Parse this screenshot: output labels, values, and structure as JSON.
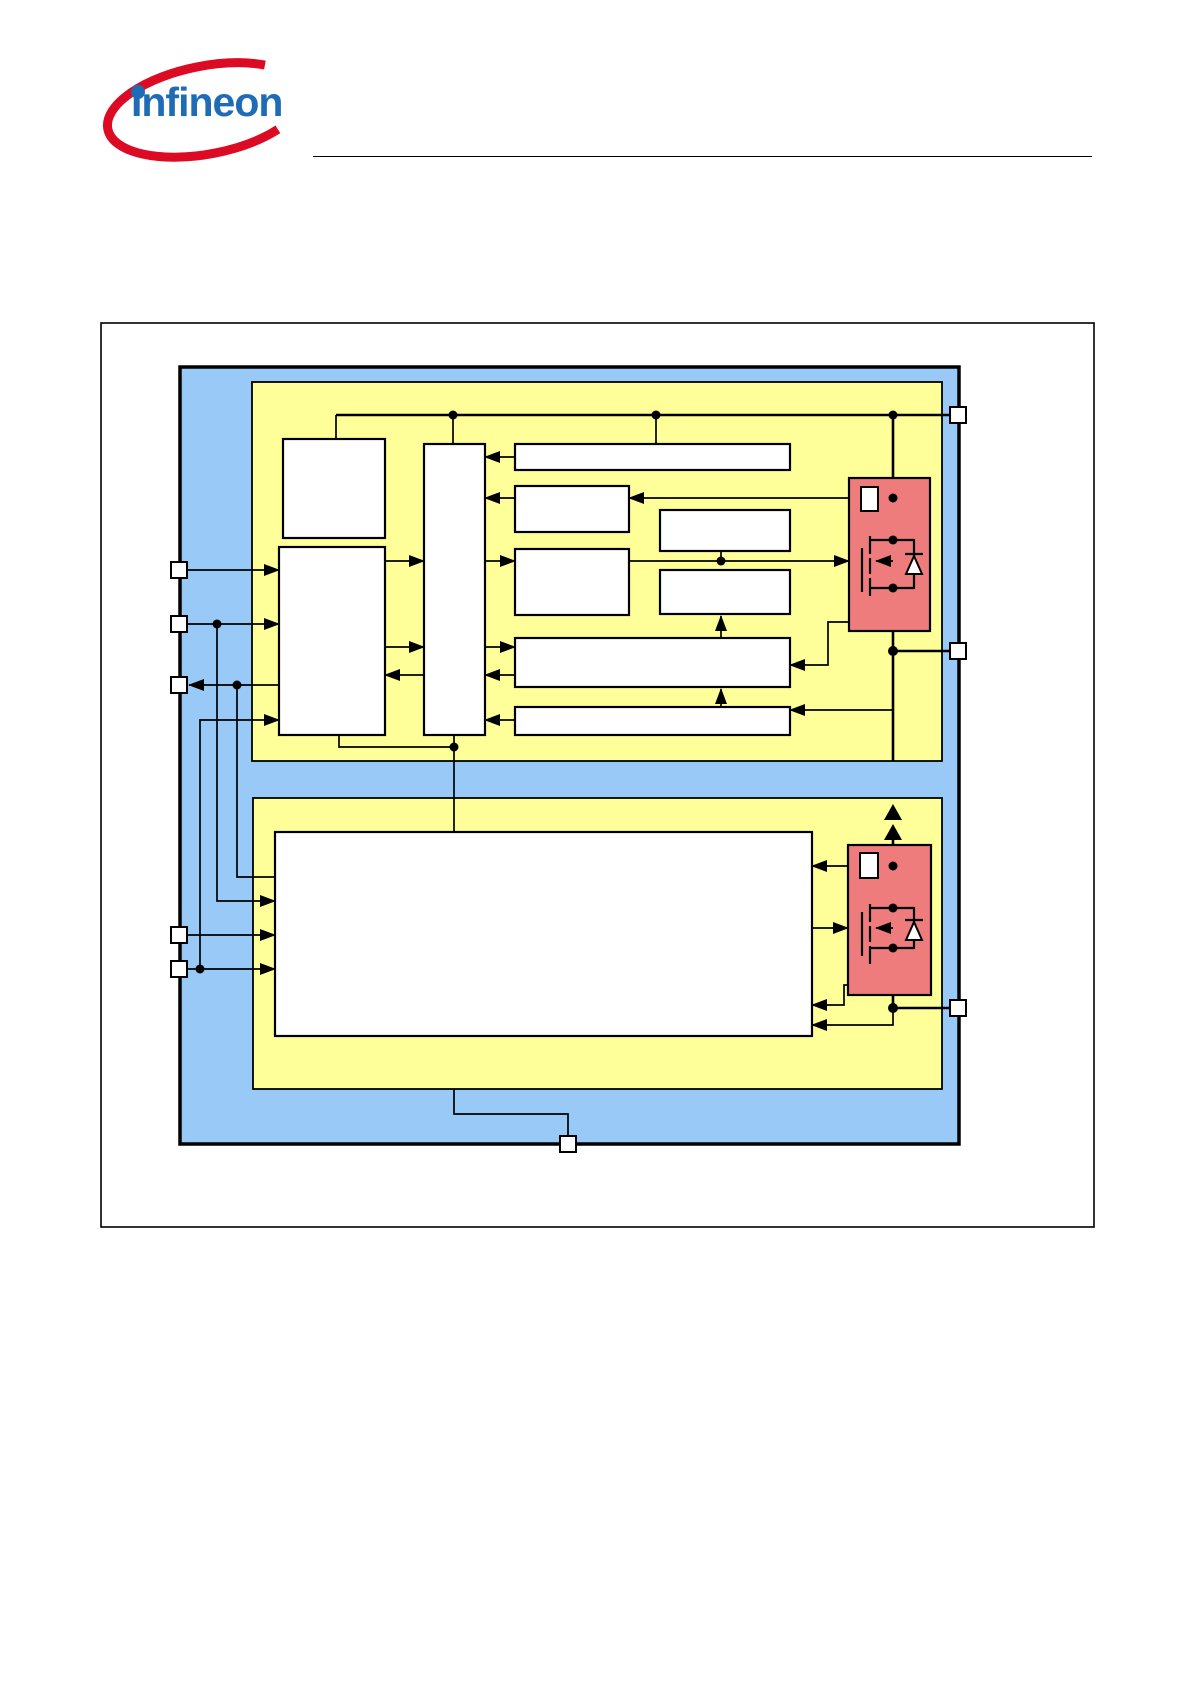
{
  "logo": {
    "text": "Infineon"
  },
  "colors": {
    "page_bg": "#FFFFFF",
    "region_blue": "#99C9F7",
    "region_yellow": "#FFFF99",
    "power_red": "#EE7C7C",
    "block_white": "#FFFFFF",
    "line_black": "#000000",
    "logo_blue": "#1E6CB5",
    "logo_red": "#DC0A23"
  },
  "figure": {
    "type": "block-diagram",
    "regions": [
      "device-region",
      "upper-subsystem",
      "lower-subsystem"
    ],
    "upper_blocks_count": 10,
    "lower_blocks_count": 1,
    "power_stages_count": 2,
    "power_stage_parts": [
      "sense-resistor",
      "mosfet",
      "body-diode"
    ],
    "pins": {
      "left": 5,
      "right": 3,
      "bottom": 1
    }
  }
}
